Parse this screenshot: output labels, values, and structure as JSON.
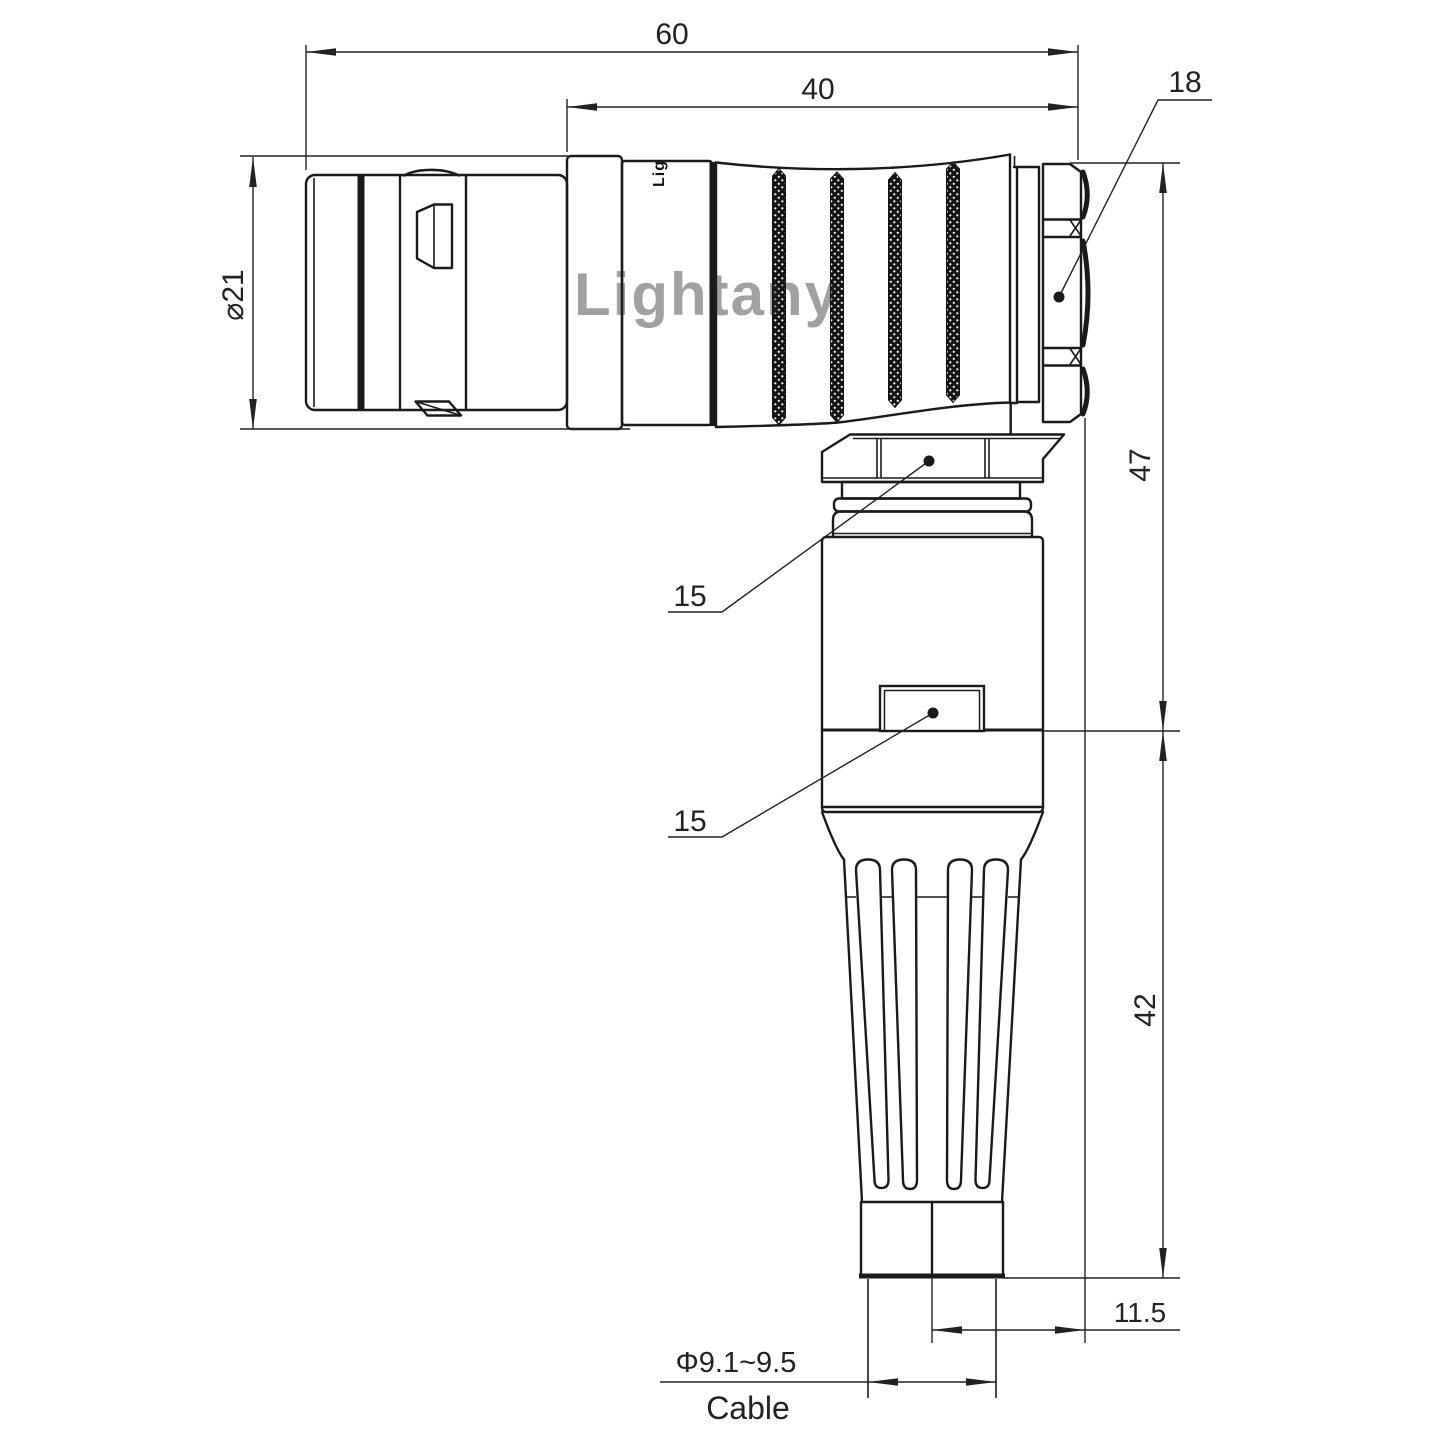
{
  "drawing": {
    "title_watermark": "Lightany",
    "brand_mark": "Lig",
    "colors": {
      "line": "#1a1a1a",
      "dimension": "#222222",
      "watermark": "#e89090"
    },
    "dimensions": {
      "overall_length": "60",
      "rear_length": "40",
      "mating_nut_size": "18",
      "plug_diameter": "⌀21",
      "upper_height": "47",
      "lower_height": "42",
      "coupling_nut_size": "15",
      "backshell_size": "15",
      "axis_offset": "11.5",
      "cable_diameter": "Φ9.1~9.5",
      "cable_label": "Cable"
    }
  }
}
